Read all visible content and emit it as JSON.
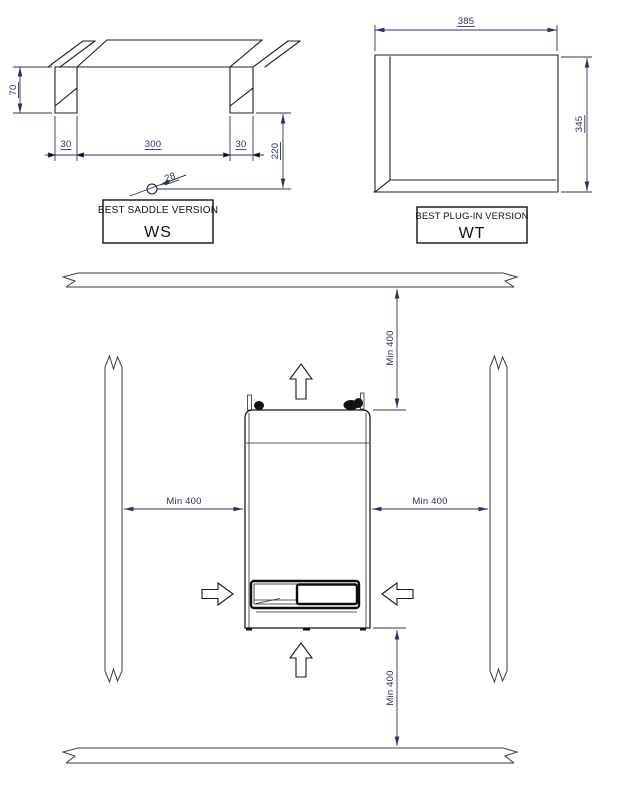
{
  "ws_drawing": {
    "dim_height": "70",
    "dim_left_tab": "30",
    "dim_span": "300",
    "dim_right_tab": "30",
    "dim_drop": "220",
    "dim_pipe": "28",
    "label_title": "BEST SADDLE VERSION",
    "label_code": "WS"
  },
  "wt_drawing": {
    "dim_width": "385",
    "dim_height": "345",
    "label_title": "BEST PLUG-IN VERSION",
    "label_code": "WT"
  },
  "clearance": {
    "top": "Min 400",
    "left": "Min 400",
    "right": "Min 400",
    "bottom": "Min 400"
  },
  "colors": {
    "dimension": "#2c3161",
    "part_line": "#1f1f1f",
    "background": "#ffffff"
  }
}
